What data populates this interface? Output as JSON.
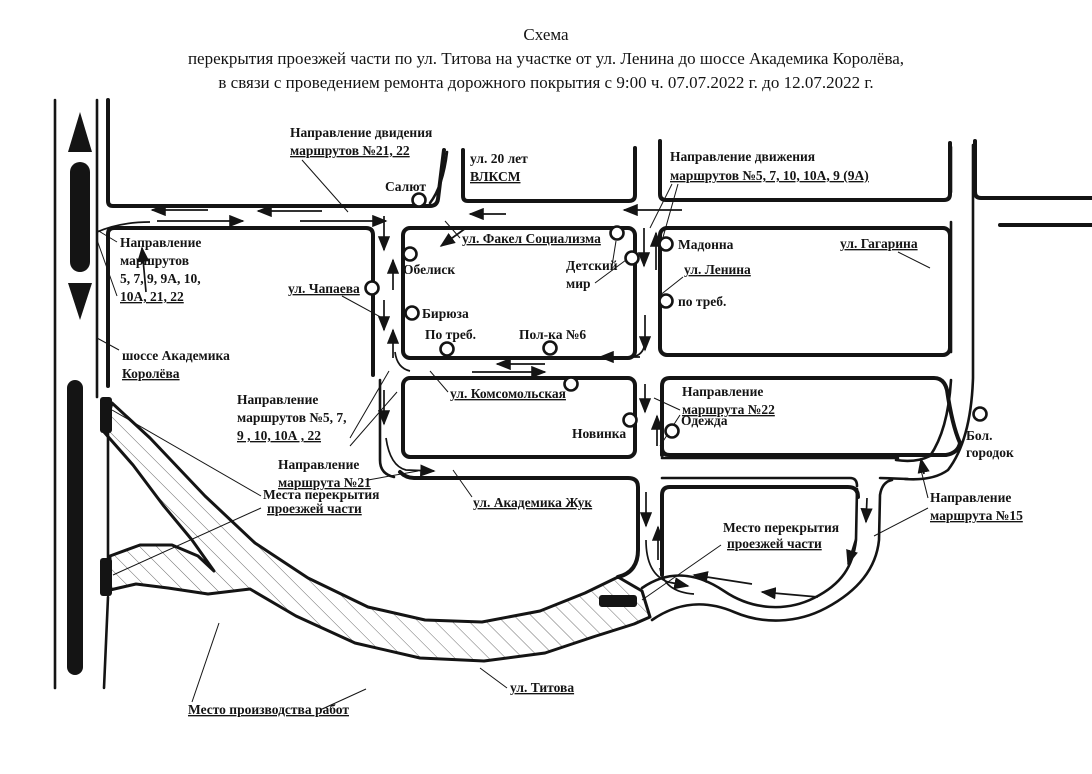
{
  "title": {
    "line1": "Схема",
    "line2": "перекрытия проезжей части по ул. Титова на участке от ул. Ленина до шоссе Академика Королёва,",
    "line3": "в связи с проведением ремонта дорожного покрытия с 9:00 ч. 07.07.2022 г. до 12.07.2022 г."
  },
  "streets": {
    "titova": "ул. Титова",
    "lenina": "ул. Ленина",
    "chapaeva": "ул. Чапаева",
    "vlksm": {
      "l1": "ул. 20 лет",
      "l2": "ВЛКСМ"
    },
    "fakel": "ул. Факел Социализма",
    "komsomolskaya": "ул. Комсомольская",
    "zhuk": "ул. Академика Жук",
    "gagarina": "ул. Гагарина",
    "shosse": {
      "l1": "шоссе Академика",
      "l2": "Королёва"
    }
  },
  "stops": {
    "salyut": "Салют",
    "obelisk": "Обелиск",
    "biryuza": "Бирюза",
    "po_treb_left": "По треб.",
    "polka6": "Пол-ка №6",
    "detsky": {
      "l1": "Детский",
      "l2": "мир"
    },
    "madonna": "Мадонна",
    "po_treb_right": "по треб.",
    "novinka": "Новинка",
    "odezhda": "Одежда",
    "bol_gorodok": {
      "l1": "Бол.",
      "l2": "городок"
    }
  },
  "labels": {
    "dir_21_22": {
      "l1": "Направление двидения",
      "l2": "маршрутов №21, 22"
    },
    "dir_5_right": {
      "l1": "Направление движения",
      "l2": "маршрутов №5, 7, 10, 10А, 9 (9А)"
    },
    "dir_left": {
      "l1": "Направление",
      "l2": "маршрутов",
      "l3": "5, 7, 9, 9А, 10,",
      "l4": "10А, 21, 22"
    },
    "dir_57": {
      "l1": "Направление",
      "l2": "маршрутов №5, 7,",
      "l3": "9 , 10, 10А , 22"
    },
    "dir_21": {
      "l1": "Направление",
      "l2": "маршрута №21"
    },
    "dir_22": {
      "l1": "Направление",
      "l2": "маршрута №22"
    },
    "dir_15": {
      "l1": "Направление",
      "l2": "маршрута №15"
    },
    "places_closure": {
      "l1": "Места перекрытия",
      "l2": "проезжей части"
    },
    "place_closure": {
      "l1": "Место перекрытия",
      "l2": "проезжей части"
    },
    "work_site": "Место производства работ"
  },
  "colors": {
    "ink": "#141414",
    "background": "#ffffff"
  }
}
